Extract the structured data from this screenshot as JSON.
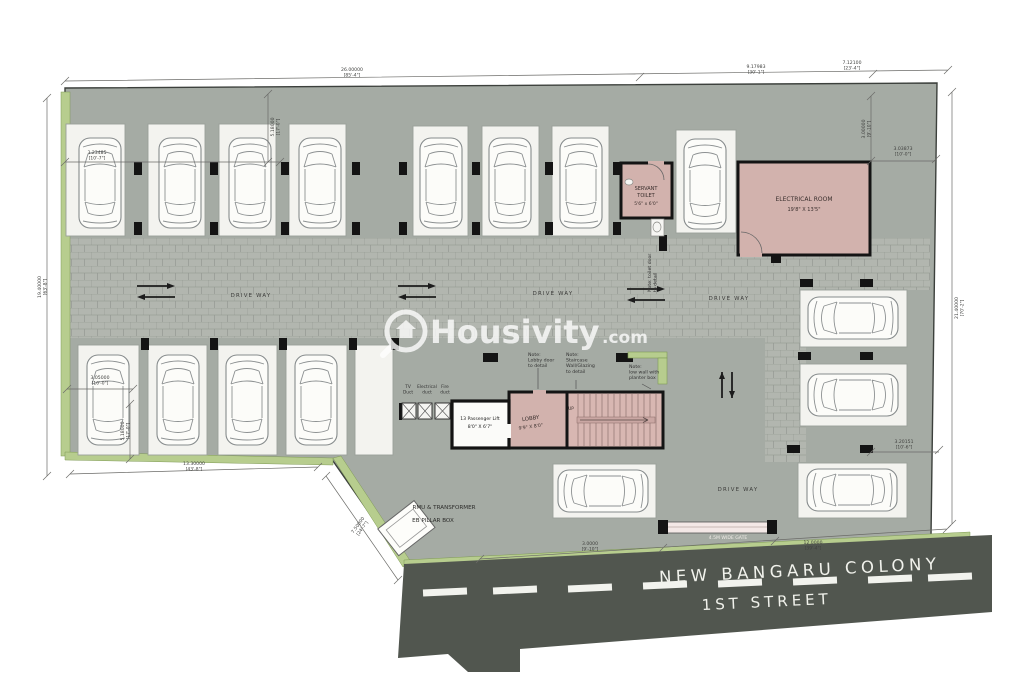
{
  "watermark": {
    "brand": "Housivity",
    "tld": ".com"
  },
  "street": {
    "colony": "NEW BANGARU COLONY",
    "street_no": "1ST STREET",
    "gate_label": "4.5M WIDE GATE"
  },
  "rooms": {
    "electrical": {
      "name": "ELECTRICAL ROOM",
      "size": "19'8\" X 13'5\""
    },
    "servant_toilet": {
      "line1": "SERVANT",
      "line2": "TOILET",
      "size": "5'6\" x 6'0\""
    },
    "lobby": {
      "name": "LOBBY",
      "size": "9'9\" X 8'0\""
    },
    "lift": {
      "name": "13 Passenger Lift",
      "size": "8'0\" X 6'7\""
    },
    "stair": {
      "up_label": "UP"
    }
  },
  "utility": {
    "rmu": "RMU & TRANSFORMER",
    "eb": "EB PILLAR BOX"
  },
  "driveway": {
    "label": "DRIVE WAY",
    "positions": [
      {
        "x": 251,
        "y": 297
      },
      {
        "x": 553,
        "y": 295
      },
      {
        "x": 729,
        "y": 300
      },
      {
        "x": 738,
        "y": 491
      }
    ]
  },
  "ducts": [
    {
      "x": 408,
      "lines": [
        "TV",
        "Duct"
      ]
    },
    {
      "x": 427,
      "lines": [
        "Electrical",
        "duct"
      ]
    },
    {
      "x": 445,
      "lines": [
        "Fire",
        "duct"
      ]
    }
  ],
  "notes": [
    {
      "x": 528,
      "y": 356,
      "lines": [
        "Note:",
        "Lobby door",
        "to detail"
      ]
    },
    {
      "x": 566,
      "y": 356,
      "lines": [
        "Note:",
        "Staircase",
        "Wall/Glazing",
        "to detail"
      ]
    },
    {
      "x": 629,
      "y": 368,
      "lines": [
        "Note:",
        "low wall with",
        "planter box"
      ]
    },
    {
      "x": 651,
      "y": 292,
      "rot": -90,
      "lines": [
        "Note: toilet door",
        "to detail"
      ]
    }
  ],
  "dimensions": [
    {
      "x": 352,
      "y": 71,
      "l1": "26.00000",
      "l2": "[85'-4\"]"
    },
    {
      "x": 756,
      "y": 68,
      "l1": "9.17983",
      "l2": "[30'-1\"]"
    },
    {
      "x": 852,
      "y": 64,
      "l1": "7.12100",
      "l2": "[23'-4\"]"
    },
    {
      "x": 41,
      "y": 287,
      "rot": -90,
      "l1": "19.40000",
      "l2": "[63'-8\"]"
    },
    {
      "x": 958,
      "y": 308,
      "rot": -90,
      "l1": "21.40000",
      "l2": "[70'-2\"]"
    },
    {
      "x": 865,
      "y": 129,
      "rot": -90,
      "l1": "3.00000",
      "l2": "[9'-10\"]"
    },
    {
      "x": 903,
      "y": 150,
      "l1": "3.03873",
      "l2": "[10'-0\"]"
    },
    {
      "x": 274,
      "y": 127,
      "rot": -90,
      "l1": "5.18000",
      "l2": "[17'-0\"]"
    },
    {
      "x": 97,
      "y": 154,
      "l1": "3.23485",
      "l2": "[10'-7\"]"
    },
    {
      "x": 100,
      "y": 379,
      "l1": "3.05000",
      "l2": "[10'-0\"]"
    },
    {
      "x": 124,
      "y": 431,
      "rot": -90,
      "l1": "5.18000",
      "l2": "[17'-0\"]"
    },
    {
      "x": 194,
      "y": 465,
      "l1": "13.30000",
      "l2": "[43'-8\"]"
    },
    {
      "x": 359,
      "y": 526,
      "rot": -54,
      "l1": "7.50000",
      "l2": "[24'-7\"]"
    },
    {
      "x": 904,
      "y": 443,
      "l1": "3.20151",
      "l2": "[10'-6\"]"
    },
    {
      "x": 590,
      "y": 545,
      "l1": "3.0000",
      "l2": "[9'-10\"]"
    },
    {
      "x": 813,
      "y": 544,
      "l1": "12.0000",
      "l2": "[39'-4\"]"
    }
  ],
  "colors": {
    "site": "#a5aba4",
    "paver": "#b2b6af",
    "paver_line": "#8f948e",
    "room_pink": "#d2b2ad",
    "stair_pink": "#d8b7b2",
    "green": "#b7cd8e",
    "road": "#51564f",
    "wall": "#141414",
    "bay": "#f3f3ef"
  },
  "plan": {
    "bays": [
      [
        66,
        124,
        59,
        112
      ],
      [
        148,
        124,
        57,
        112
      ],
      [
        219,
        124,
        57,
        112
      ],
      [
        289,
        124,
        57,
        112
      ],
      [
        413,
        126,
        55,
        110
      ],
      [
        482,
        126,
        57,
        110
      ],
      [
        552,
        126,
        57,
        110
      ],
      [
        676,
        130,
        60,
        103
      ],
      [
        78,
        345,
        61,
        110
      ],
      [
        148,
        345,
        59,
        110
      ],
      [
        218,
        345,
        59,
        110
      ],
      [
        286,
        345,
        61,
        110
      ],
      [
        355,
        345,
        38,
        110
      ],
      [
        800,
        290,
        107,
        57
      ],
      [
        800,
        364,
        107,
        62
      ],
      [
        798,
        463,
        109,
        55
      ],
      [
        553,
        464,
        103,
        54
      ]
    ],
    "cars": [
      {
        "x": 100,
        "y": 183
      },
      {
        "x": 180,
        "y": 183
      },
      {
        "x": 250,
        "y": 183
      },
      {
        "x": 320,
        "y": 183
      },
      {
        "x": 441,
        "y": 183
      },
      {
        "x": 510,
        "y": 183
      },
      {
        "x": 581,
        "y": 183
      },
      {
        "x": 705,
        "y": 184
      },
      {
        "x": 108,
        "y": 400
      },
      {
        "x": 178,
        "y": 400
      },
      {
        "x": 247,
        "y": 400
      },
      {
        "x": 316,
        "y": 400
      },
      {
        "x": 853,
        "y": 318,
        "rot": -90
      },
      {
        "x": 853,
        "y": 395,
        "rot": -90
      },
      {
        "x": 852,
        "y": 490,
        "rot": -90
      },
      {
        "x": 603,
        "y": 491,
        "rot": -90
      }
    ],
    "columns": [
      [
        134,
        162,
        8,
        13
      ],
      [
        210,
        162,
        8,
        13
      ],
      [
        281,
        162,
        8,
        13
      ],
      [
        352,
        162,
        8,
        13
      ],
      [
        399,
        162,
        8,
        13
      ],
      [
        472,
        162,
        8,
        13
      ],
      [
        545,
        162,
        8,
        13
      ],
      [
        613,
        162,
        8,
        13
      ],
      [
        134,
        222,
        8,
        13
      ],
      [
        210,
        222,
        8,
        13
      ],
      [
        281,
        222,
        8,
        13
      ],
      [
        352,
        222,
        8,
        13
      ],
      [
        399,
        222,
        8,
        13
      ],
      [
        472,
        222,
        8,
        13
      ],
      [
        545,
        222,
        8,
        13
      ],
      [
        613,
        222,
        8,
        13
      ],
      [
        141,
        338,
        8,
        12
      ],
      [
        210,
        338,
        8,
        12
      ],
      [
        279,
        338,
        8,
        12
      ],
      [
        349,
        338,
        8,
        12
      ],
      [
        391,
        338,
        8,
        12
      ],
      [
        800,
        279,
        13,
        8
      ],
      [
        860,
        279,
        13,
        8
      ],
      [
        798,
        352,
        13,
        8
      ],
      [
        860,
        352,
        13,
        8
      ],
      [
        787,
        445,
        13,
        8
      ],
      [
        860,
        445,
        13,
        8
      ],
      [
        483,
        353,
        15,
        9
      ],
      [
        616,
        353,
        17,
        9
      ],
      [
        771,
        255,
        10,
        8
      ],
      [
        659,
        235,
        8,
        16
      ]
    ],
    "arrows": [
      {
        "x": 137,
        "y": 286,
        "t": "h"
      },
      {
        "x": 398,
        "y": 286,
        "t": "h"
      },
      {
        "x": 627,
        "y": 289,
        "t": "h"
      },
      {
        "x": 722,
        "y": 372,
        "t": "v"
      }
    ],
    "lane_dashes": [
      {
        "x": 445,
        "y": 592
      },
      {
        "x": 515,
        "y": 590
      },
      {
        "x": 590,
        "y": 588
      },
      {
        "x": 665,
        "y": 585
      },
      {
        "x": 740,
        "y": 583
      },
      {
        "x": 815,
        "y": 581
      },
      {
        "x": 890,
        "y": 579
      },
      {
        "x": 950,
        "y": 577
      }
    ],
    "stair": {
      "x1": 578,
      "x2": 657,
      "y1": 394,
      "y2": 446,
      "step": 6
    }
  }
}
